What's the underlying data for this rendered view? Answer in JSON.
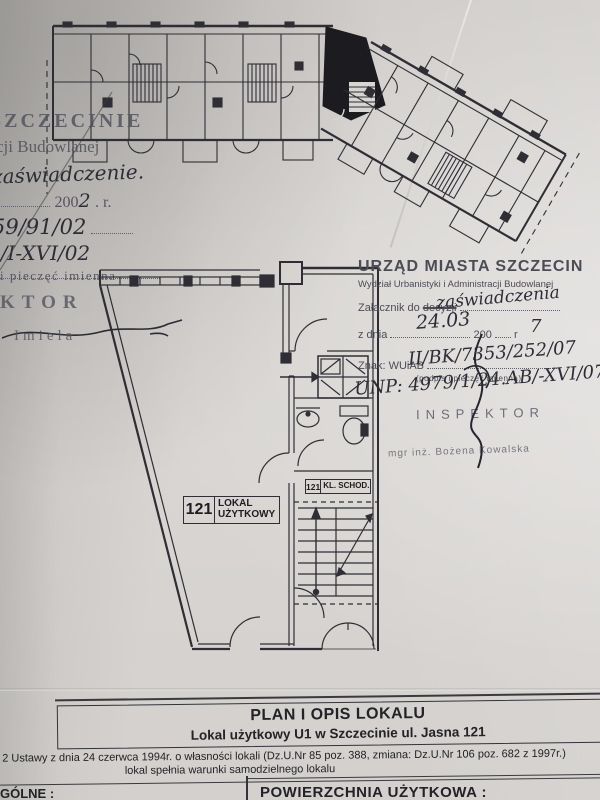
{
  "colors": {
    "paper": "#d6d3d0",
    "ink": "#2e2e34",
    "stamp_ink": "#54545e",
    "handwriting": "#2c2d35"
  },
  "left_stamp": {
    "fragment1": "SZCZECINIE",
    "fragment2": "cji Budowlanej",
    "hand_note": "zaświadczenie.",
    "date_print": "200",
    "date_hand": "2",
    "date_suffix": ". r.",
    "hand_num1": "59/91/02",
    "hand_num2": "B/I-XVI/02",
    "caption": "i pieczęć imienna",
    "inspector_fragment": "KTOR",
    "name": "Imiela"
  },
  "right_stamp": {
    "title": "URZĄD MIASTA SZCZECIN",
    "dept": "Wydział Urbanistyki i Administracji Budowlanej",
    "attach_label": "Załącznik do",
    "attach_struck": "decyzji",
    "attach_hand": "zaświadczenia",
    "date_label": "z dnia",
    "date_hand_day": "24.03",
    "date_print": "200",
    "date_hand_year": "7",
    "date_r": "r",
    "znak_label": "Znak: WUiAB",
    "znak_hand": "II/BK/7353/252/07",
    "caption": "(podpis i pieczęć imienna)",
    "unp_hand": "UNP: 4979/1/24.AB/-XVI/07",
    "inspector": "INSPEKTOR",
    "inspector_name": "mgr inż. Bożena Kowalska"
  },
  "plan_labels": {
    "unit_no": "121",
    "unit_line1": "LOKAL",
    "unit_line2": "UŻYTKOWY",
    "stair_no": "121",
    "stair_label": "KL. SCHOD."
  },
  "footer": {
    "title": "PLAN I OPIS LOKALU",
    "subtitle": "Lokal użytkowy U1 w Szczecinie ul. Jasna 121",
    "legal1": "Art. 2 Ustawy z dnia 24 czerwca 1994r. o własności lokali (Dz.U.Nr 85 poz. 388, zmiana: Dz.U.Nr 106 poz. 682 z 1997r.)",
    "legal2": "lokal spełnia warunki samodzielnego lokalu",
    "left_cell": "GÓLNE :",
    "right_cell": "POWIERZCHNIA UŻYTKOWA :"
  }
}
